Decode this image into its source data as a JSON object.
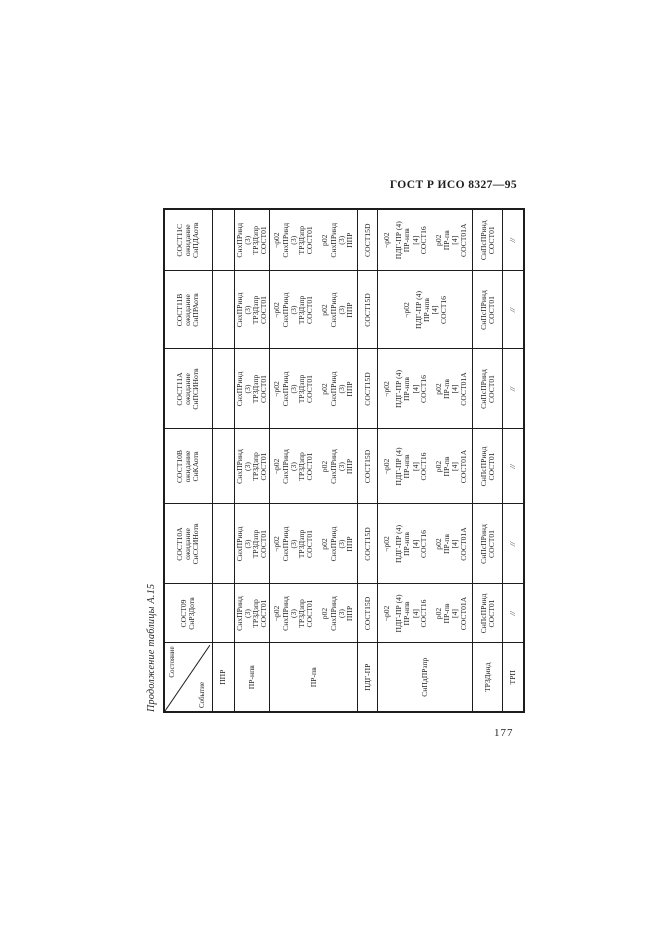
{
  "colors": {
    "ink": "#1d1d1d",
    "paper": "#ffffff"
  },
  "page": {
    "doc_header": "ГОСТ Р ИСО 8327—95",
    "table_caption": "Продолжение таблицы А.15",
    "page_number": "177"
  },
  "table": {
    "corner": {
      "state_label": "Состояние",
      "event_label": "Событие"
    },
    "state_headers": [
      [
        "СОСТ09",
        "СнРЗДотв"
      ],
      [
        "СОСТ10А",
        "ожидание",
        "СнССИНотв"
      ],
      [
        "СОСТ10В",
        "ожидание",
        "СнКАотв"
      ],
      [
        "СОСТ11А",
        "ожидание",
        "СнПСИНотв"
      ],
      [
        "СОСТ11В",
        "ожидание",
        "СнПРАотв"
      ],
      [
        "СОСТ11С",
        "ожидание",
        "СнПДАотв"
      ]
    ],
    "rows": [
      {
        "event": "ППР",
        "cells": [
          [],
          [],
          [],
          [],
          [],
          []
        ]
      },
      {
        "event": "ПР-нпв",
        "cells": [
          [
            [
              "СнхПРинд",
              "(3)",
              "ТРЗДзпр",
              "СОСТ01"
            ]
          ],
          [
            [
              "СнхПРинд",
              "(3)",
              "ТРЗДзпр",
              "СОСТ01"
            ]
          ],
          [
            [
              "СнхПРинд",
              "(3)",
              "ТРЗДзпр",
              "СОСТ01"
            ]
          ],
          [
            [
              "СнхПРинд",
              "(3)",
              "ТРЗДзпр",
              "СОСТ01"
            ]
          ],
          [
            [
              "СнхПРинд",
              "(3)",
              "ТРЗДзпр",
              "СОСТ01"
            ]
          ],
          [
            [
              "СнхПРинд",
              "(3)",
              "ТРЗДзпр",
              "СОСТ01"
            ]
          ]
        ]
      },
      {
        "event": "ПР-пв",
        "cells": [
          [
            [
              "¬р02",
              "СнхПРинд",
              "(3)",
              "ТРЗДзпр",
              "СОСТ01"
            ],
            [
              "р02",
              "СнхПРинд",
              "(3)",
              "ППР"
            ]
          ],
          [
            [
              "¬р02",
              "СнхПРинд",
              "(3)",
              "ТРЗДзпр",
              "СОСТ01"
            ],
            [
              "р02",
              "СнхПРинд",
              "(3)",
              "ППР"
            ]
          ],
          [
            [
              "¬р02",
              "СнхПРинд",
              "(3)",
              "ТРЗДзпр",
              "СОСТ01"
            ],
            [
              "р02",
              "СнхПРинд",
              "(3)",
              "ППР"
            ]
          ],
          [
            [
              "¬р02",
              "СнхПРинд",
              "(3)",
              "ТРЗДзпр",
              "СОСТ01"
            ],
            [
              "р02",
              "СнхПРинд",
              "(3)",
              "ППР"
            ]
          ],
          [
            [
              "¬р02",
              "СнхПРинд",
              "(3)",
              "ТРЗДзпр",
              "СОСТ01"
            ],
            [
              "р02",
              "СнхПРинд",
              "(3)",
              "ППР"
            ]
          ],
          [
            [
              "¬р02",
              "СнхПРинд",
              "(3)",
              "ТРЗДзпр",
              "СОСТ01"
            ],
            [
              "р02",
              "СнхПРинд",
              "(3)",
              "ППР"
            ]
          ]
        ]
      },
      {
        "event": "ПДГ-ПР",
        "cells": [
          [
            [
              "СОСТ15D"
            ]
          ],
          [
            [
              "СОСТ15D"
            ]
          ],
          [
            [
              "СОСТ15D"
            ]
          ],
          [
            [
              "СОСТ15D"
            ]
          ],
          [
            [
              "СОСТ15D"
            ]
          ],
          [
            [
              "СОСТ15D"
            ]
          ]
        ]
      },
      {
        "event": "СнПдПРзпр",
        "cells": [
          [
            [
              "¬р02"
            ],
            [
              "ПДГ-ПР (4)",
              "ПР-нпв",
              "[4]",
              "СОСТ16"
            ],
            [
              "р02",
              "ПР-пв",
              "[4]",
              "СОСТ01А"
            ]
          ],
          [
            [
              "¬р02"
            ],
            [
              "ПДГ-ПР (4)",
              "ПР-нпв",
              "[4]",
              "СОСТ16"
            ],
            [
              "р02",
              "ПР-пв",
              "[4]",
              "СОСТ01А"
            ]
          ],
          [
            [
              "¬р02"
            ],
            [
              "ПДГ-ПР (4)",
              "ПР-нпв",
              "[4]",
              "СОСТ16"
            ],
            [
              "р02",
              "ПР-пв",
              "[4]",
              "СОСТ01А"
            ]
          ],
          [
            [
              "¬р02"
            ],
            [
              "ПДГ-ПР (4)",
              "ПР-нпв",
              "[4]",
              "СОСТ16"
            ],
            [
              "р02",
              "ПР-пв",
              "[4]",
              "СОСТ01А"
            ]
          ],
          [
            [
              "¬р02"
            ],
            [
              "ПДГ-ПР (4)",
              "ПР-нпв",
              "[4]",
              "СОСТ16"
            ]
          ],
          [
            [
              "¬р02"
            ],
            [
              "ПДГ-ПР (4)",
              "ПР-нпв",
              "[4]",
              "СОСТ16"
            ],
            [
              "р02",
              "ПР-пв",
              "[4]",
              "СОСТ01А"
            ]
          ]
        ]
      },
      {
        "event": "ТРЗДинд",
        "cells": [
          [
            [
              "СнПсПРинд",
              "СОСТ01"
            ]
          ],
          [
            [
              "СнПсПРинд",
              "СОСТ01"
            ]
          ],
          [
            [
              "СнПсПРинд",
              "СОСТ01"
            ]
          ],
          [
            [
              "СнПсПРинд",
              "СОСТ01"
            ]
          ],
          [
            [
              "СнПсПРинд",
              "СОСТ01"
            ]
          ],
          [
            [
              "СнПсПРинд",
              "СОСТ01"
            ]
          ]
        ]
      },
      {
        "event": "ТРП",
        "cells": [
          [
            [
              "//"
            ]
          ],
          [
            [
              "//"
            ]
          ],
          [
            [
              "//"
            ]
          ],
          [
            [
              "//"
            ]
          ],
          [
            [
              "//"
            ]
          ],
          [
            [
              "//"
            ]
          ]
        ]
      }
    ]
  }
}
